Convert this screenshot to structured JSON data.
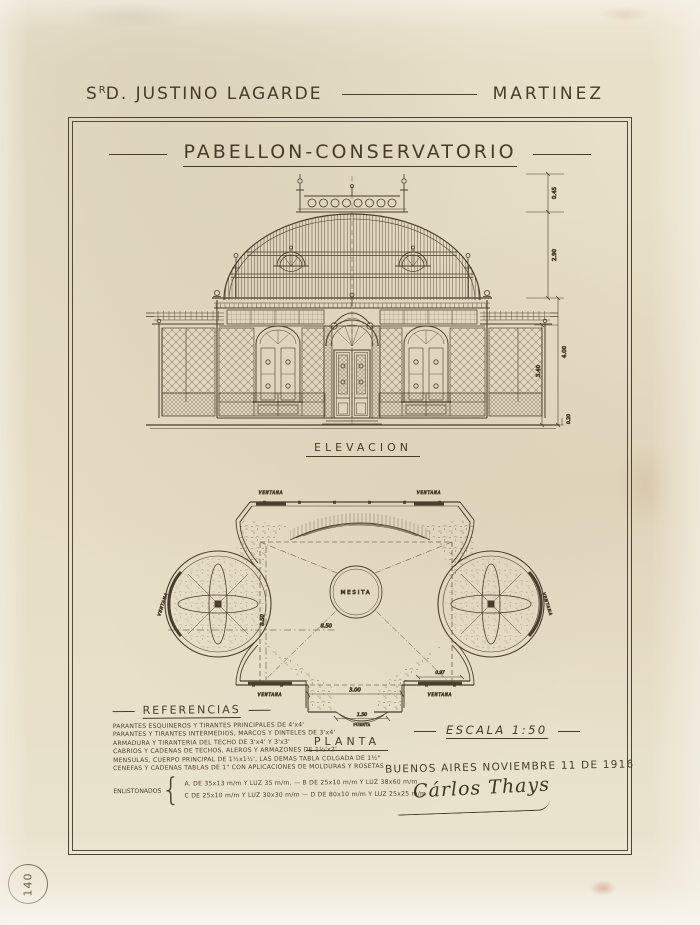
{
  "owner": {
    "prefix": "S",
    "sup": "R",
    "mid": "D.",
    "name": "JUSTINO LAGARDE",
    "surname": "MARTINEZ"
  },
  "title": "PABELLON-CONSERVATORIO",
  "elevation": {
    "label": "ELEVACION",
    "dims": {
      "crest": "0.45",
      "dome": "2.90",
      "outer": "4.00",
      "inner": "3.40",
      "plinth": "0.20"
    }
  },
  "plan": {
    "label": "PLANTA",
    "center": "MESITA",
    "window": "VENTANA",
    "dims": {
      "width": "8.50",
      "depth": "8.50",
      "entry": "3.00",
      "door": "1.50",
      "door_word": "PUERTA",
      "side": "0.97"
    }
  },
  "references": {
    "title": "REFERENCIAS",
    "lines": [
      "PARANTES ESQUINEROS Y TIRANTES PRINCIPALES DE 4'x4'",
      "PARANTES Y TIRANTES INTERMEDIOS, MARCOS Y DINTELES DE 3'x4'",
      "ARMADURA Y TIRANTERIA DEL TECHO DE 3'x4' Y 3'x3'",
      "CABRIOS Y CADENAS DE TECHOS, ALEROS Y ARMAZONES DE 1½'x2'",
      "MENSULAS, CUERPO PRINCIPAL DE 1½x1½', LAS DEMAS TABLA COLGADA DE 1½\"",
      "CENEFAS Y CADENAS TABLAS DE 1\" CON APLICACIONES DE MOLDURAS Y ROSETAS"
    ],
    "enlist_label": "ENLISTONADOS",
    "brace": "{",
    "enlist_lines": [
      "A. DE 35x13 m/m Y LUZ 35 m/m.  —  B DE 25x10 m/m Y LUZ 38x60 m/m",
      "C DE 25x10 m/m Y LUZ 30x30 m/m  —  D DE 80x10 m/m Y LUZ 25x25 m/m"
    ]
  },
  "footer": {
    "scale": "ESCALA 1:50",
    "date": "BUENOS AIRES NOVIEMBRE 11 DE 1916",
    "signature": "Cárlos Thays"
  },
  "stamp": "140",
  "colors": {
    "paper": "#e8e0c9",
    "ink": "#473c2a"
  }
}
